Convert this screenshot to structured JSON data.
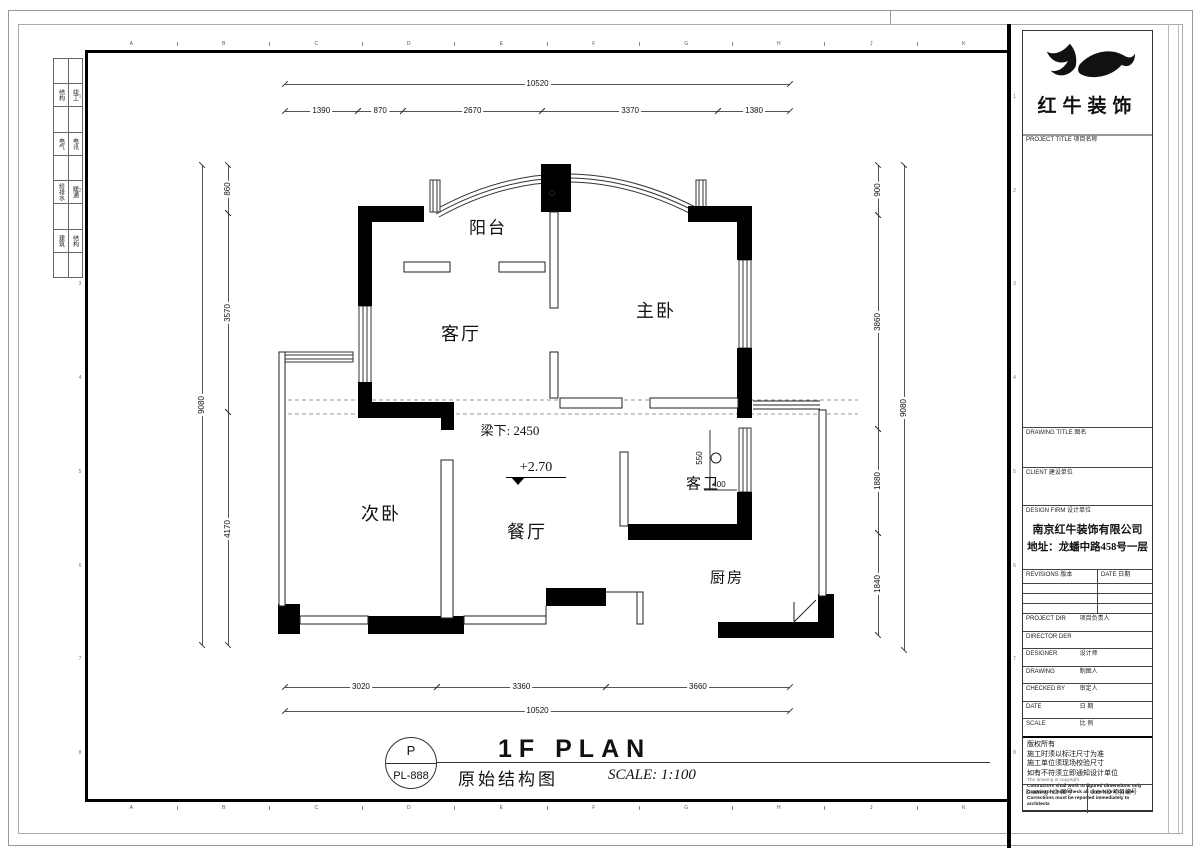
{
  "frame": {
    "ruler_letters": [
      "A",
      "B",
      "C",
      "D",
      "E",
      "F",
      "G",
      "H",
      "J",
      "K"
    ],
    "ruler_numbers": [
      "1",
      "2",
      "3",
      "4",
      "5",
      "6",
      "7",
      "8"
    ]
  },
  "disciplines": {
    "rows": [
      {
        "left": "结构",
        "right": "竣工"
      },
      {
        "left": "电气",
        "right": "电讯"
      },
      {
        "left": "给排水",
        "right": "暖通"
      },
      {
        "left": "建筑",
        "right": "结构"
      }
    ]
  },
  "plan": {
    "rooms": {
      "balcony": "阳台",
      "living": "客厅",
      "master": "主卧",
      "second": "次卧",
      "dining": "餐厅",
      "bath": "客卫",
      "kitchen": "厨房"
    },
    "annotations": {
      "beam": "梁下: 2450",
      "level": "+2.70",
      "dim_550": "550",
      "dim_400": "400"
    },
    "dimensions": {
      "top": {
        "overall": "10520",
        "segments": [
          "1390",
          "870",
          "2670",
          "3370",
          "1380"
        ]
      },
      "bottom": {
        "overall": "10520",
        "segments": [
          "3020",
          "3360",
          "3660"
        ]
      },
      "left": {
        "overall": "9080",
        "segments": [
          "860",
          "3570",
          "4170"
        ]
      },
      "right": {
        "overall": "9080",
        "segments": [
          "900",
          "3860",
          "1880",
          "1840"
        ]
      }
    }
  },
  "titlebar": {
    "circle_top": "P",
    "circle_bottom": "PL-888",
    "title_en": "1F PLAN",
    "title_cn": "原始结构图",
    "scale": "SCALE: 1:100"
  },
  "titleblock": {
    "brand": "红牛装饰",
    "project_title": "PROJECT TITLE  项目名称",
    "drawing_title": "DRAWING TITLE  图名",
    "client": "CLIENT  建设单位",
    "design_firm": "DESIGN FIRM  设计单位",
    "company": "南京红牛装饰有限公司",
    "address": "地址：龙蟠中路458号一层",
    "revisions": "REVISIONS  版本",
    "date_col": "DATE  日期",
    "rows": [
      {
        "en": "PROJECT DIR",
        "cn": "项目负责人"
      },
      {
        "en": "DIRECTOR DER",
        "cn": ""
      },
      {
        "en": "DESIGNER",
        "cn": "设计师"
      },
      {
        "en": "DRAWING",
        "cn": "制图人"
      },
      {
        "en": "CHECKED BY",
        "cn": "审定人"
      },
      {
        "en": "DATE",
        "cn": "日  期"
      },
      {
        "en": "SCALE",
        "cn": "比  例"
      }
    ],
    "notes_cn": [
      "版权所有",
      "施工时须以标注尺寸为准",
      "施工单位须现场校验尺寸",
      "如有不符须立即通知设计单位"
    ],
    "notes_en": [
      "The drawing is copyright",
      "Contractors shall work to figured dimensions only",
      "Contractors must check all dimensions on site",
      "Corrections must be reported immediately to architects"
    ],
    "footer": {
      "drawing_no": "Drawing NO 图号",
      "job_no": "Job NO 项目编号"
    }
  }
}
